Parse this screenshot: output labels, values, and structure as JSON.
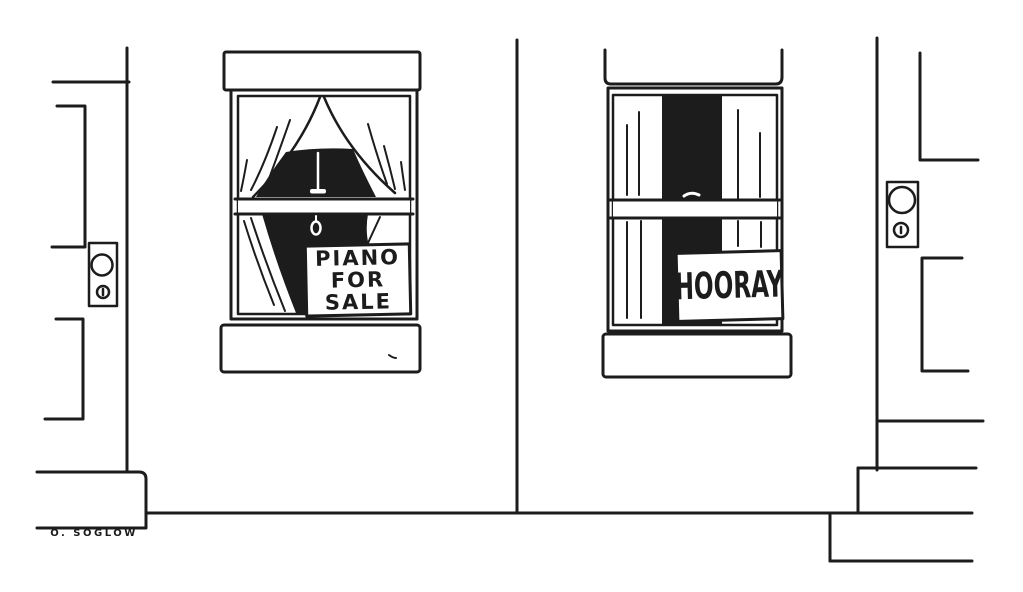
{
  "signs": {
    "piano": {
      "line1": "PIANO",
      "line2": "FOR",
      "line3": "SALE"
    },
    "hooray": {
      "text": "HOORAY"
    }
  },
  "signature": {
    "text": "O. SOGLOW"
  },
  "colors": {
    "ink": "#1c1c1c",
    "paper": "#ffffff"
  }
}
